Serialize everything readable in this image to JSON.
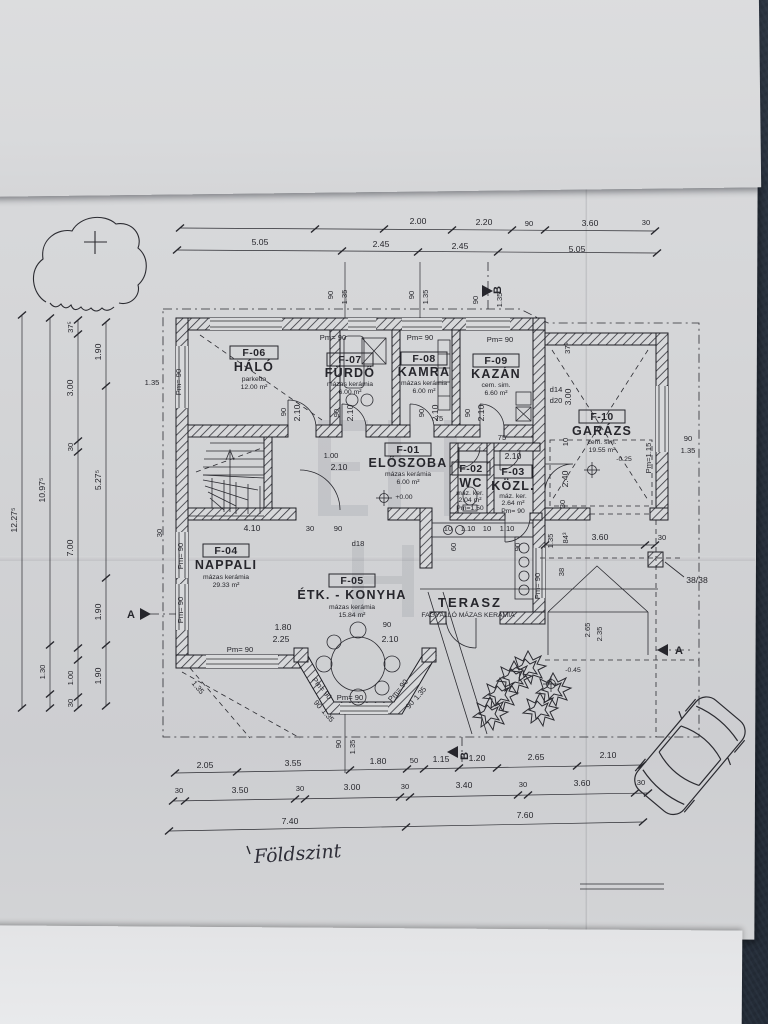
{
  "note": "Földszint",
  "rooms": [
    {
      "id": "F-01",
      "name": "ELŐSZOBA",
      "finish": "mázas kerámia",
      "area": "6.00 m²"
    },
    {
      "id": "F-02",
      "name": "WC",
      "finish": "máz. ker.",
      "area": "2.04 m²"
    },
    {
      "id": "F-03",
      "name": "KÖZL.",
      "finish": "máz. ker.",
      "area": "2.64 m²"
    },
    {
      "id": "F-04",
      "name": "NAPPALI",
      "finish": "mázas kerámia",
      "area": "29.33 m²"
    },
    {
      "id": "F-05",
      "name": "ÉTK. - KONYHA",
      "finish": "mázas kerámia",
      "area": "15.84 m²"
    },
    {
      "id": "F-06",
      "name": "HÁLÓ",
      "finish": "parketta",
      "area": "12.00 m²"
    },
    {
      "id": "F-07",
      "name": "FÜRDŐ",
      "finish": "mázas kerámia",
      "area": "6.00 m²"
    },
    {
      "id": "F-08",
      "name": "KAMRA",
      "finish": "mázas kerámia",
      "area": "6.00 m²"
    },
    {
      "id": "F-09",
      "name": "KAZÁN",
      "finish": "cem. sim.",
      "area": "6.60 m²"
    },
    {
      "id": "F-10",
      "name": "GARÁZS",
      "finish": "cem. sim.",
      "area": "19.55 m²"
    }
  ],
  "terrace": {
    "name": "TERASZ",
    "finish": "FAGYÁLLÓ MÁZAS KERÁMIA"
  },
  "levels": {
    "entry": "+0.00",
    "garage": "-0.25",
    "terrace": "-0.45"
  },
  "labels": {
    "pm90": "Pm= 90",
    "pm150": "Pm=1.50",
    "pm115": "Pm=1.15"
  },
  "markers": {
    "a": "A",
    "b": "B"
  },
  "dims": {
    "top1": [
      "2.00",
      "2.20",
      "90",
      "3.60",
      "30"
    ],
    "top2": [
      "5.05",
      "2.45",
      "2.45",
      "5.05"
    ],
    "top_small": [
      "90",
      "1.35",
      "90",
      "1.35",
      "90",
      "1.35"
    ],
    "left1": "12.27⁵",
    "left2": [
      "10.97⁵",
      "1.30"
    ],
    "left3": [
      "37⁵",
      "3.00",
      "30",
      "7.00",
      "1.00",
      "30"
    ],
    "left4": [
      "1.90",
      "5.27⁵",
      "1.90",
      "1.90"
    ],
    "bottom1": [
      "2.05",
      "3.55",
      "1.80",
      "50",
      "1.15",
      "1.20",
      "2.65",
      "2.10"
    ],
    "bottom2": [
      "30",
      "3.50",
      "30",
      "3.00",
      "30",
      "3.40",
      "30",
      "3.60",
      "30"
    ],
    "bottom3": [
      "7.40",
      "7.60"
    ],
    "right": {
      "w90": "90",
      "w135": "1.35",
      "v360": "3.60",
      "v30": "30",
      "v843": "84³",
      "v38": "38",
      "pillar": "38/38",
      "t265": "2.65",
      "t235": "2.35"
    },
    "inner": {
      "hall_w": "4.10",
      "n30": "30",
      "n90": "90",
      "d18": "d18",
      "d14": "d14",
      "d20": "d20",
      "g300": "3.00",
      "g375": "37⁵",
      "g10": "10",
      "g240": "2.40",
      "g30": "30",
      "door90": "90",
      "door210": "2.10",
      "w75": "75",
      "e100": "1.00",
      "e210": "2.10",
      "b180": "1.80",
      "b225": "2.25",
      "b135": "1.35",
      "c10": "10",
      "c110": "1.10",
      "c60": "60",
      "c90": "90",
      "c135": "1.35",
      "l135": "1.35"
    }
  }
}
